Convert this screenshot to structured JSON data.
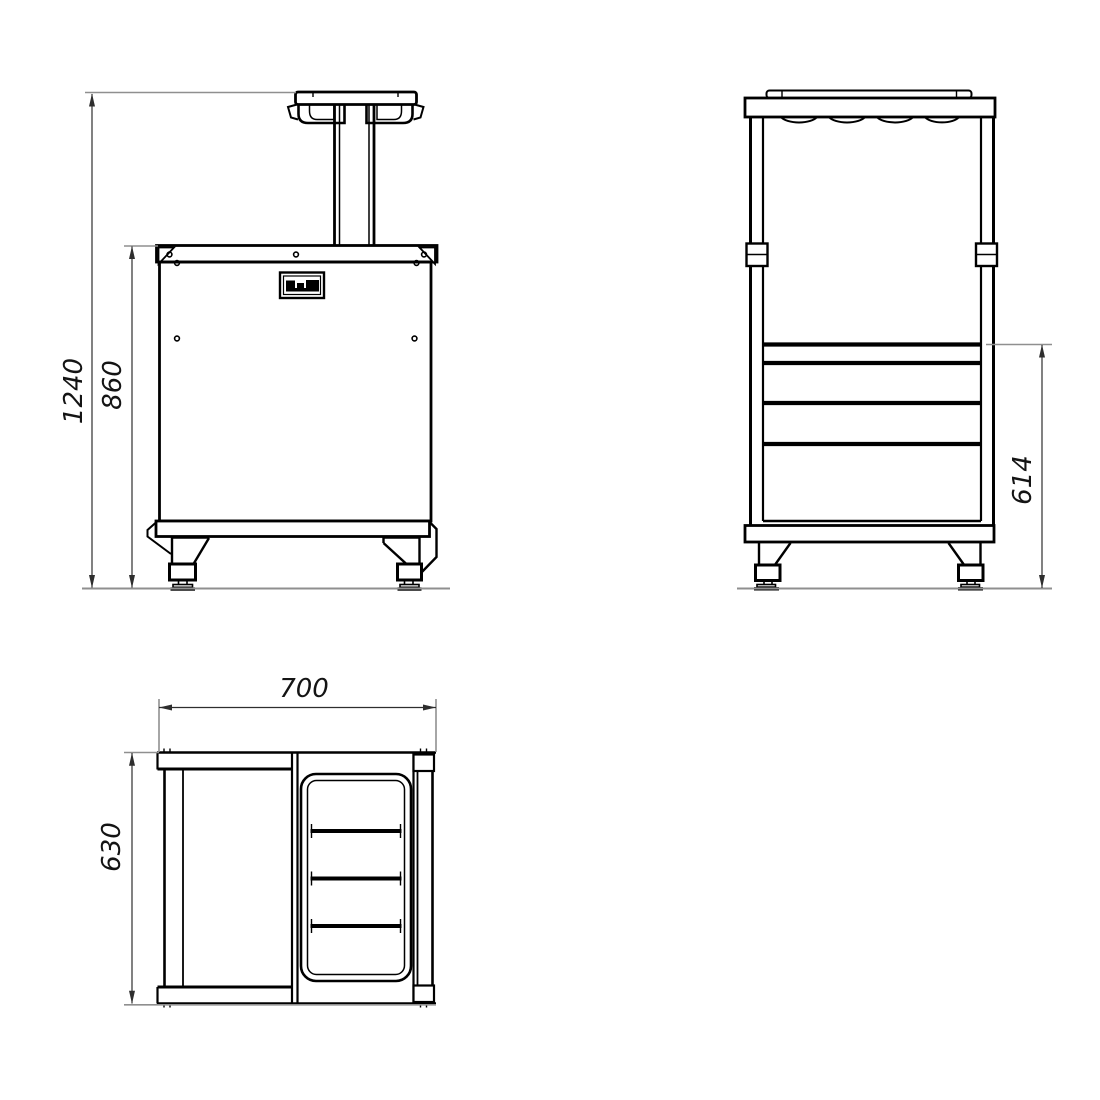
{
  "style": {
    "background_color": "#ffffff",
    "outline_color": "#000000",
    "dimension_line_color": "#2e2e2e",
    "extension_line_color": "#8f8f8f",
    "text_color": "#141414"
  },
  "views": {
    "front": {
      "dimensions": {
        "overall_height": "1240",
        "cabinet_height": "860"
      }
    },
    "side": {
      "dimensions": {
        "rail_height": "614"
      }
    },
    "top": {
      "dimensions": {
        "overall_width": "700",
        "overall_depth": "630"
      }
    }
  }
}
